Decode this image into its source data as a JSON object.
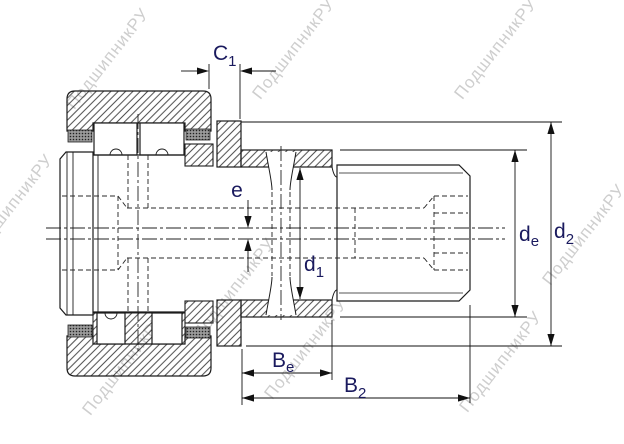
{
  "drawing_title": "cam-follower-bearing-cross-section",
  "dimensions": {
    "c1": {
      "base": "C",
      "sub": "1"
    },
    "e": {
      "base": "e",
      "sub": ""
    },
    "d1": {
      "base": "d",
      "sub": "1"
    },
    "de": {
      "base": "d",
      "sub": "e"
    },
    "d2": {
      "base": "d",
      "sub": "2"
    },
    "be": {
      "base": "B",
      "sub": "e"
    },
    "b2": {
      "base": "B",
      "sub": "2"
    }
  },
  "watermark": {
    "text": "ПодшипникРУ",
    "color": "#c6c6c6"
  },
  "colors": {
    "line": "#1c1c1c",
    "dim_text": "#1a1a5e",
    "background": "#ffffff"
  }
}
